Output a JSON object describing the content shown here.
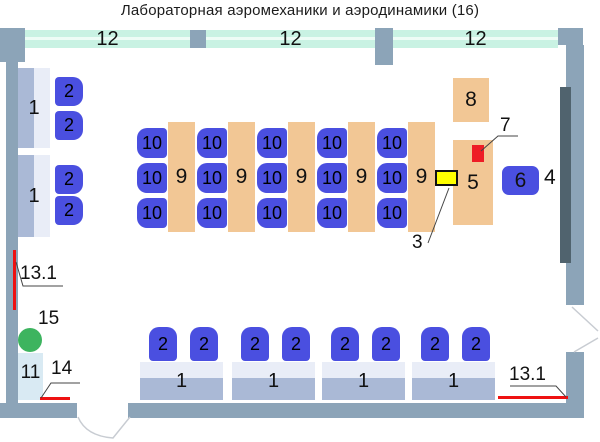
{
  "title": "Лабораторная аэромеханики и аэродинамики (16)",
  "windows": [
    {
      "label": "12"
    },
    {
      "label": "12"
    },
    {
      "label": "12"
    }
  ],
  "left_desks": [
    {
      "label": "1",
      "chairs": [
        "2",
        "2"
      ]
    },
    {
      "label": "1",
      "chairs": [
        "2",
        "2"
      ]
    }
  ],
  "middle_desks": [
    {
      "label": "9",
      "chairs": [
        "10",
        "10",
        "10"
      ]
    },
    {
      "label": "9",
      "chairs": [
        "10",
        "10",
        "10"
      ]
    },
    {
      "label": "9",
      "chairs": [
        "10",
        "10",
        "10"
      ]
    },
    {
      "label": "9",
      "chairs": [
        "10",
        "10",
        "10"
      ]
    },
    {
      "label": "9",
      "chairs": [
        "10",
        "10",
        "10"
      ]
    }
  ],
  "bottom_desks": [
    {
      "label": "1",
      "chairs": [
        "2",
        "2"
      ]
    },
    {
      "label": "1",
      "chairs": [
        "2",
        "2"
      ]
    },
    {
      "label": "1",
      "chairs": [
        "2",
        "2"
      ]
    },
    {
      "label": "1",
      "chairs": [
        "2",
        "2"
      ]
    }
  ],
  "items": {
    "item8": "8",
    "item5": "5",
    "item7": "7",
    "item3": "3",
    "item6": "6",
    "item4": "4"
  },
  "annotations": {
    "left_13_1": "13.1",
    "right_13_1": "13.1",
    "label_14": "14",
    "label_15": "15",
    "label_11": "11"
  },
  "colors": {
    "wall": "#8ca4b8",
    "window_glass": "#c9f2e3",
    "desk_tan": "#f2c795",
    "chair_blue": "#4a4fe0",
    "desk_light": "#e9edf7",
    "desk_dark": "#aab9d6",
    "cabinet_pale": "#d9eaf3",
    "marker_green": "#3db45f",
    "alarm_red": "#ee1111",
    "switch_yellow": "#ffff00",
    "board_dark": "#50636e"
  }
}
